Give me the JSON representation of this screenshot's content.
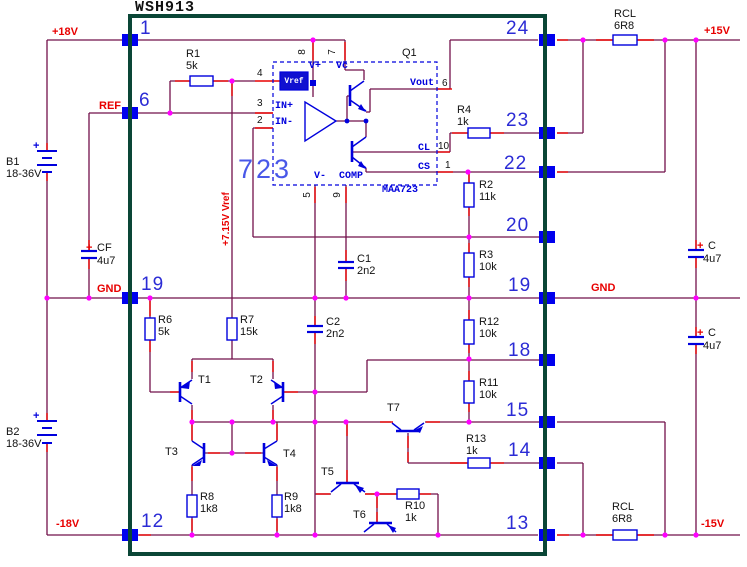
{
  "title": "WSH913",
  "nets": {
    "p18v": "+18V",
    "ref": "REF",
    "gnd_left": "GND",
    "n18v": "-18V",
    "p15v": "+15V",
    "gnd_right": "GND",
    "n15v": "-15V",
    "vref_note": "+7.15V Vref"
  },
  "pins": {
    "left": {
      "p1": "1",
      "p6": "6",
      "p19": "19",
      "p12": "12"
    },
    "right": {
      "p24": "24",
      "p23": "23",
      "p22": "22",
      "p20": "20",
      "p19": "19",
      "p18": "18",
      "p15": "15",
      "p14": "14",
      "p13": "13"
    }
  },
  "regulator": {
    "big_label": "723",
    "part": "MAA723",
    "q": "Q1",
    "vref_box": "Vref",
    "labels": {
      "vplus": "V+",
      "vc": "Vc",
      "in_plus": "IN+",
      "in_minus": "IN-",
      "vminus": "V-",
      "comp": "COMP",
      "vout": "Vout",
      "cl": "CL",
      "cs": "CS"
    },
    "pin_numbers": {
      "n8": "8",
      "n7": "7",
      "n4": "4",
      "n3": "3",
      "n2": "2",
      "n5": "5",
      "n9": "9",
      "n6": "6",
      "n10": "10",
      "n1": "1"
    }
  },
  "components": {
    "b1": {
      "ref": "B1",
      "value": "18-36V",
      "plus": "+"
    },
    "b2": {
      "ref": "B2",
      "value": "18-36V",
      "plus": "+"
    },
    "cf": {
      "ref": "CF",
      "value": "4u7",
      "plus": "+"
    },
    "c_top": {
      "ref": "C",
      "value": "4u7",
      "plus": "+"
    },
    "c_bot": {
      "ref": "C",
      "value": "4u7",
      "plus": "+"
    },
    "c1": {
      "ref": "C1",
      "value": "2n2"
    },
    "c2": {
      "ref": "C2",
      "value": "2n2"
    },
    "r1": {
      "ref": "R1",
      "value": "5k"
    },
    "r2": {
      "ref": "R2",
      "value": "11k"
    },
    "r3": {
      "ref": "R3",
      "value": "10k"
    },
    "r4": {
      "ref": "R4",
      "value": "1k"
    },
    "r6": {
      "ref": "R6",
      "value": "5k"
    },
    "r7": {
      "ref": "R7",
      "value": "15k"
    },
    "r8": {
      "ref": "R8",
      "value": "1k8"
    },
    "r9": {
      "ref": "R9",
      "value": "1k8"
    },
    "r10": {
      "ref": "R10",
      "value": "1k"
    },
    "r11": {
      "ref": "R11",
      "value": "10k"
    },
    "r12": {
      "ref": "R12",
      "value": "10k"
    },
    "r13": {
      "ref": "R13",
      "value": "1k"
    },
    "rcl_top": {
      "ref": "RCL",
      "value": "6R8"
    },
    "rcl_bot": {
      "ref": "RCL",
      "value": "6R8"
    },
    "t1": "T1",
    "t2": "T2",
    "t3": "T3",
    "t4": "T4",
    "t5": "T5",
    "t6": "T6",
    "t7": "T7"
  },
  "colors": {
    "wire": "#72104a",
    "accent_red": "#e80000",
    "component_blue": "#0000dd",
    "junction": "#ff00ff",
    "box_green": "#0a4636"
  }
}
